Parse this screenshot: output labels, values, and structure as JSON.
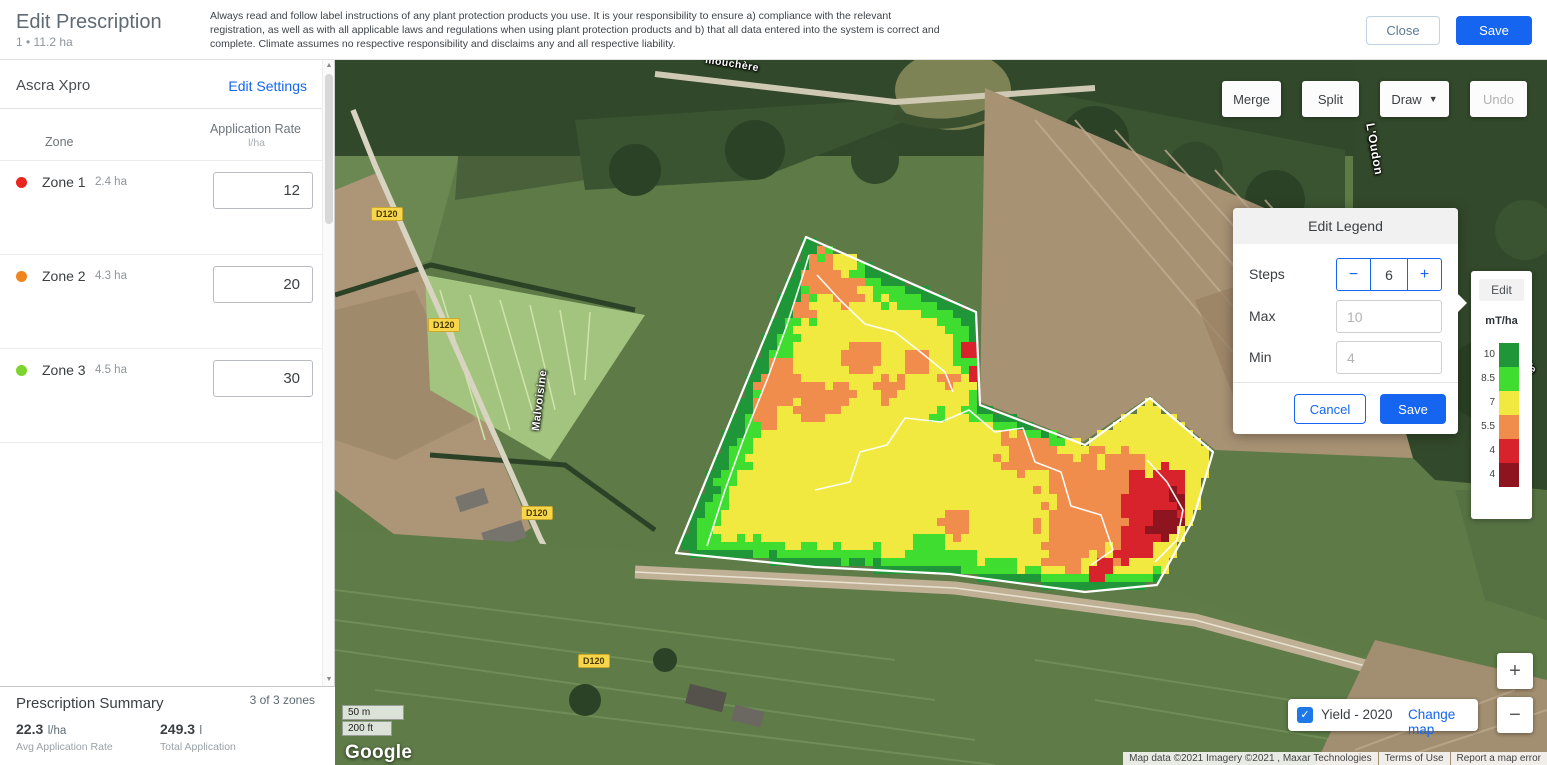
{
  "header": {
    "title": "Edit Prescription",
    "subtitle": "1 • 11.2 ha",
    "disclaimer": "Always read and follow label instructions of any plant protection products you use. It is your responsibility to ensure a) compliance with the relevant registration, as well as with all applicable laws and regulations when using plant protection products and b) that all data entered into the system is correct and complete. Climate assumes no respective responsibility and disclaims any and all respective liability.",
    "close_label": "Close",
    "save_label": "Save"
  },
  "sidebar": {
    "product_name": "Ascra Xpro",
    "edit_settings_label": "Edit Settings",
    "columns": {
      "zone": "Zone",
      "rate": "Application Rate",
      "rate_unit": "l/ha"
    },
    "zones": [
      {
        "name": "Zone 1",
        "area": "2.4 ha",
        "rate": "12",
        "color": "#e8251f"
      },
      {
        "name": "Zone 2",
        "area": "4.3 ha",
        "rate": "20",
        "color": "#f0841f"
      },
      {
        "name": "Zone 3",
        "area": "4.5 ha",
        "rate": "30",
        "color": "#7ed32f"
      }
    ],
    "summary": {
      "title": "Prescription Summary",
      "zones_count": "3 of 3 zones",
      "avg_value": "22.3",
      "avg_unit": "l/ha",
      "avg_label": "Avg Application Rate",
      "total_value": "249.3",
      "total_unit": "l",
      "total_label": "Total Application"
    }
  },
  "map": {
    "toolbar": {
      "merge": "Merge",
      "split": "Split",
      "draw": "Draw",
      "undo": "Undo"
    },
    "edit_legend": {
      "title": "Edit Legend",
      "steps_label": "Steps",
      "steps_value": "6",
      "minus": "−",
      "plus": "+",
      "max_label": "Max",
      "max_placeholder": "10",
      "min_label": "Min",
      "min_placeholder": "4",
      "cancel_label": "Cancel",
      "save_label": "Save"
    },
    "legend": {
      "edit_label": "Edit",
      "unit": "mT/ha",
      "steps": [
        {
          "label": "10",
          "color": "#1f9638"
        },
        {
          "label": "8.5",
          "color": "#3fdd2f"
        },
        {
          "label": "7",
          "color": "#f1e93f"
        },
        {
          "label": "5.5",
          "color": "#f08c4c"
        },
        {
          "label": "4",
          "color": "#d8232c"
        },
        {
          "label": "4",
          "color": "#8e1520"
        }
      ]
    },
    "layer_toggle": {
      "checkmark": "✓",
      "label": "Yield - 2020",
      "change_label": "Change map"
    },
    "zoom_in": "+",
    "zoom_out": "−",
    "scale": {
      "metric": "50 m",
      "imperial": "200 ft"
    },
    "google_logo": "Google",
    "attribution": {
      "map_data": "Map data ©2021 Imagery ©2021 , Maxar Technologies",
      "terms": "Terms of Use",
      "report": "Report a map error"
    },
    "labels": {
      "road_badge": "D120",
      "street": "Malvoisine",
      "river": "L'Oudon",
      "top_road": "mouchère",
      "partial": "Te"
    },
    "road_badges": [
      {
        "x": 51,
        "y": 154
      },
      {
        "x": 108,
        "y": 265
      },
      {
        "x": 201,
        "y": 453
      },
      {
        "x": 258,
        "y": 601
      }
    ],
    "field": {
      "cell": 8,
      "bbox": [
        330,
        170,
        890,
        542
      ],
      "polygon": [
        [
          471,
          177
        ],
        [
          641,
          252
        ],
        [
          645,
          345
        ],
        [
          750,
          385
        ],
        [
          815,
          338
        ],
        [
          878,
          392
        ],
        [
          858,
          460
        ],
        [
          822,
          525
        ],
        [
          750,
          532
        ],
        [
          615,
          514
        ],
        [
          480,
          507
        ],
        [
          341,
          493
        ]
      ],
      "palette": {
        "yellow": "#f1e93f",
        "green": "#3fdd2f",
        "darkgreen": "#1f9638",
        "orange": "#f08c4c",
        "red": "#d8232c",
        "darkred": "#8e1520"
      },
      "edge_bands": [
        {
          "chain": [
            [
              341,
              493
            ],
            [
              471,
              177
            ]
          ],
          "widths": [
            [
              13,
              "darkgreen"
            ],
            [
              32,
              "green"
            ]
          ],
          "rim": true
        },
        {
          "chain": [
            [
              341,
              493
            ],
            [
              480,
              507
            ],
            [
              615,
              514
            ]
          ],
          "widths": [
            [
              8,
              "darkgreen"
            ],
            [
              20,
              "green"
            ]
          ],
          "rim": true
        },
        {
          "chain": [
            [
              615,
              514
            ],
            [
              700,
              522
            ],
            [
              790,
              530
            ],
            [
              822,
              525
            ]
          ],
          "widths": [
            [
              6,
              "darkgreen"
            ],
            [
              14,
              "green"
            ]
          ],
          "rim": true
        },
        {
          "chain": [
            [
              540,
              208
            ],
            [
              641,
              252
            ],
            [
              642,
              285
            ]
          ],
          "widths": [
            [
              10,
              "darkgreen"
            ],
            [
              26,
              "green"
            ]
          ],
          "rim": false
        },
        {
          "chain": [
            [
              645,
              345
            ],
            [
              720,
              372
            ]
          ],
          "widths": [
            [
              7,
              "darkgreen"
            ],
            [
              15,
              "green"
            ]
          ],
          "rim": false
        }
      ],
      "blobs": [
        {
          "x": 480,
          "y": 212,
          "r": 20,
          "c": "orange"
        },
        {
          "x": 512,
          "y": 232,
          "r": 15,
          "c": "orange"
        },
        {
          "x": 462,
          "y": 252,
          "r": 13,
          "c": "orange"
        },
        {
          "x": 445,
          "y": 322,
          "r": 24,
          "c": "orange"
        },
        {
          "x": 478,
          "y": 345,
          "r": 22,
          "c": "orange"
        },
        {
          "x": 430,
          "y": 352,
          "r": 16,
          "c": "orange"
        },
        {
          "x": 508,
          "y": 335,
          "r": 14,
          "c": "orange"
        },
        {
          "x": 528,
          "y": 298,
          "r": 17,
          "c": "orange"
        },
        {
          "x": 556,
          "y": 330,
          "r": 14,
          "c": "orange"
        },
        {
          "x": 585,
          "y": 302,
          "r": 13,
          "c": "orange"
        },
        {
          "x": 612,
          "y": 318,
          "r": 10,
          "c": "orange"
        },
        {
          "x": 688,
          "y": 390,
          "r": 22,
          "c": "orange"
        },
        {
          "x": 712,
          "y": 400,
          "r": 14,
          "c": "orange"
        },
        {
          "x": 622,
          "y": 464,
          "r": 15,
          "c": "orange"
        },
        {
          "x": 760,
          "y": 450,
          "r": 50,
          "c": "orange"
        },
        {
          "x": 730,
          "y": 492,
          "r": 22,
          "c": "orange"
        },
        {
          "x": 790,
          "y": 412,
          "r": 22,
          "c": "orange"
        },
        {
          "x": 633,
          "y": 290,
          "r": 11,
          "c": "red"
        },
        {
          "x": 638,
          "y": 312,
          "r": 9,
          "c": "red"
        },
        {
          "x": 818,
          "y": 442,
          "r": 30,
          "c": "red"
        },
        {
          "x": 798,
          "y": 482,
          "r": 20,
          "c": "red"
        },
        {
          "x": 764,
          "y": 510,
          "r": 13,
          "c": "red"
        },
        {
          "x": 836,
          "y": 420,
          "r": 14,
          "c": "red"
        },
        {
          "x": 830,
          "y": 462,
          "r": 15,
          "c": "darkred"
        },
        {
          "x": 843,
          "y": 438,
          "r": 11,
          "c": "darkred"
        },
        {
          "x": 592,
          "y": 494,
          "r": 18,
          "c": "green"
        },
        {
          "x": 634,
          "y": 502,
          "r": 13,
          "c": "green"
        },
        {
          "x": 670,
          "y": 508,
          "r": 11,
          "c": "green"
        },
        {
          "x": 636,
          "y": 352,
          "r": 9,
          "c": "green"
        },
        {
          "x": 606,
          "y": 357,
          "r": 7,
          "c": "green"
        },
        {
          "x": 726,
          "y": 378,
          "r": 8,
          "c": "green"
        }
      ],
      "zone_lines": [
        "M 372,486 L 390,430 L 410,375 L 432,320 L 452,265 L 468,215 L 474,195",
        "M 480,430 L 515,422 L 525,392 L 552,385 L 570,358 L 606,362 L 634,350 L 660,372 L 688,368 L 700,402 L 726,412 L 736,446 L 766,455 L 778,490 L 756,505",
        "M 482,215 L 505,240 L 530,264 L 560,272 L 588,294 L 610,312 L 618,332",
        "M 812,400 L 832,422 L 848,450 L 842,480 L 820,502"
      ]
    }
  }
}
